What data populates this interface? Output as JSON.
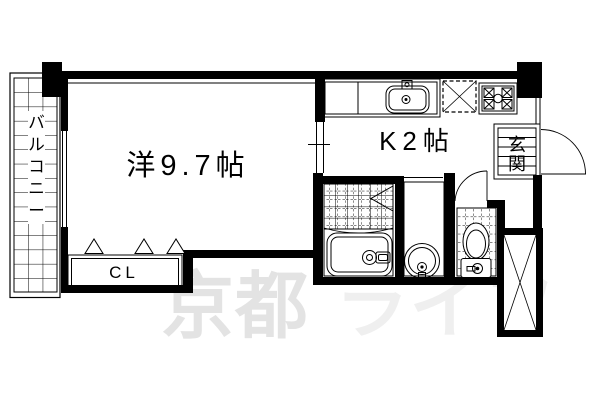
{
  "rooms": {
    "balcony": {
      "label": "バルコニー",
      "chars": [
        "バ",
        "ル",
        "コ",
        "ニ",
        "ー"
      ]
    },
    "main_room": {
      "label": "洋9.7帖"
    },
    "kitchen": {
      "label": "K2帖"
    },
    "closet": {
      "label": "CL"
    },
    "entrance": {
      "label": "玄関",
      "chars": [
        "玄",
        "関"
      ]
    }
  },
  "watermark": {
    "text_left": "京都",
    "text_right": "ライフ",
    "color_left": "#e3e3e3",
    "color_right": "#efefef"
  },
  "colors": {
    "line": "#000000",
    "background": "#ffffff"
  }
}
